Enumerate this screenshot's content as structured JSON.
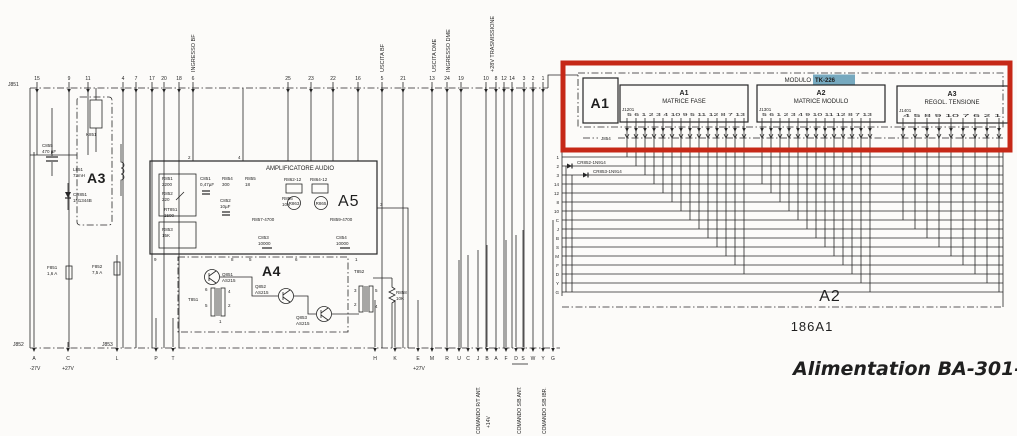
{
  "title": "Alimentation BA-301-A",
  "connectors": {
    "j851": "J851",
    "j852": "J852",
    "j853": "J853",
    "j854": "J854",
    "top_pins": [
      "15",
      "9",
      "11",
      "4",
      "7",
      "17",
      "20",
      "18",
      "6",
      "25",
      "23",
      "22",
      "16",
      "5",
      "21",
      "13",
      "24",
      "19",
      "10",
      "8",
      "12",
      "14",
      "3",
      "2",
      "1"
    ],
    "top_labels": {
      "ingresso_bf": "INGRESSO BF",
      "uscita_bf": "USCITA BF",
      "uscita_dme": "USCITA DME",
      "ingresso_dme": "INGRESSO DME",
      "trasmissione": "+28V TRASMISSIONE"
    },
    "bottom_left_pins": [
      "A",
      "C",
      "L",
      "P",
      "T"
    ],
    "minus27": "-27V",
    "plus27": "+27V",
    "plus27_mid": "+27V",
    "bottom_pins": [
      "H",
      "K",
      "E",
      "M",
      "R",
      "U",
      "C",
      "J",
      "B",
      "A",
      "F",
      "D",
      "S",
      "W",
      "Y",
      "G"
    ],
    "bottom_labels": {
      "rt_ant": "COMANDO R/T ANT.",
      "v14": "+14V",
      "sb_ant": "COMANDO S/B ANT.",
      "sb_ibr": "COMANDO S/B IBR."
    },
    "row_labels": [
      "1",
      "2",
      "3",
      "14",
      "12",
      "8",
      "10",
      "C",
      "J",
      "B",
      "S",
      "M",
      "F",
      "D",
      "Y",
      "G"
    ]
  },
  "module": {
    "big_label": "A1",
    "modulo_label": "MODULO",
    "tk_label": "TK-226",
    "a1": {
      "title": "A1",
      "subtitle": "MATRICE FASE",
      "conn": "J1201",
      "pins": "5 6 1 2 3 4 10 9 5 11 12 8 7 13"
    },
    "a2": {
      "title": "A2",
      "subtitle": "MATRICE MODULO",
      "conn": "J1301",
      "pins": "5 6 1 2 3 4 9 10 11 12 8 7 13"
    },
    "a3": {
      "title": "A3",
      "subtitle": "REGOL. TENSIONE",
      "conn": "J1401",
      "pins": "4 5 8 9 10 7 6 2 1"
    }
  },
  "backplane": {
    "a2_label": "A2",
    "unit_label": "186A1",
    "diode1": "CR852-1N914",
    "diode2": "CR853-1N914"
  },
  "block_a3": {
    "label": "A3",
    "k851": "K851",
    "c855": "C855",
    "c855_val": "470 µF",
    "l851": "L851",
    "l851_val": "73mH",
    "cr851": "CR851",
    "cr851_val": "1N1344B",
    "f851": "F851",
    "f851_val": "1,6 A",
    "f852": "F852",
    "f852_val": "7,5 A"
  },
  "block_a5": {
    "label": "A5",
    "block_title": "AMPLIFICATORE AUDIO",
    "r851": "R851",
    "r851_val": "2200",
    "r852": "R852",
    "r852_val": "220",
    "rt851": "RT851",
    "rt851_val": "1500",
    "r853": "R853",
    "r853_val": "15K",
    "c851": "C851",
    "c851_val": "0,47µF",
    "r854": "R854",
    "r854_val": "300",
    "c852": "C852",
    "c852_val": "10µF",
    "r855": "R855",
    "r855_val": "18",
    "r856": "R856",
    "r856_val": "10K",
    "r857": "R857-4700",
    "r862": "R862-12",
    "r864": "R864-12",
    "r863": "R863",
    "r865": "R865",
    "c853": "C853",
    "c853_val": "10000",
    "r859": "R859-4700",
    "c854": "C854",
    "c854_val": "10000",
    "pin2": "2",
    "pin4": "4",
    "pin3": "3",
    "pin9": "9",
    "pin8": "8",
    "pin5": "5",
    "pin6": "6",
    "pin1": "1"
  },
  "block_a4": {
    "label": "A4",
    "t851": "T851",
    "q851": "Q851",
    "q851_val": "AS215",
    "q852": "Q852",
    "q852_val": "AS215",
    "q853": "Q853",
    "q853_val": "AS215",
    "t852": "T852",
    "r858": "R858",
    "r858_val": "10K",
    "t851_pins": [
      "6",
      "4",
      "2",
      "5",
      "1"
    ],
    "t852_pins": [
      "3",
      "2",
      "5",
      "4"
    ]
  }
}
